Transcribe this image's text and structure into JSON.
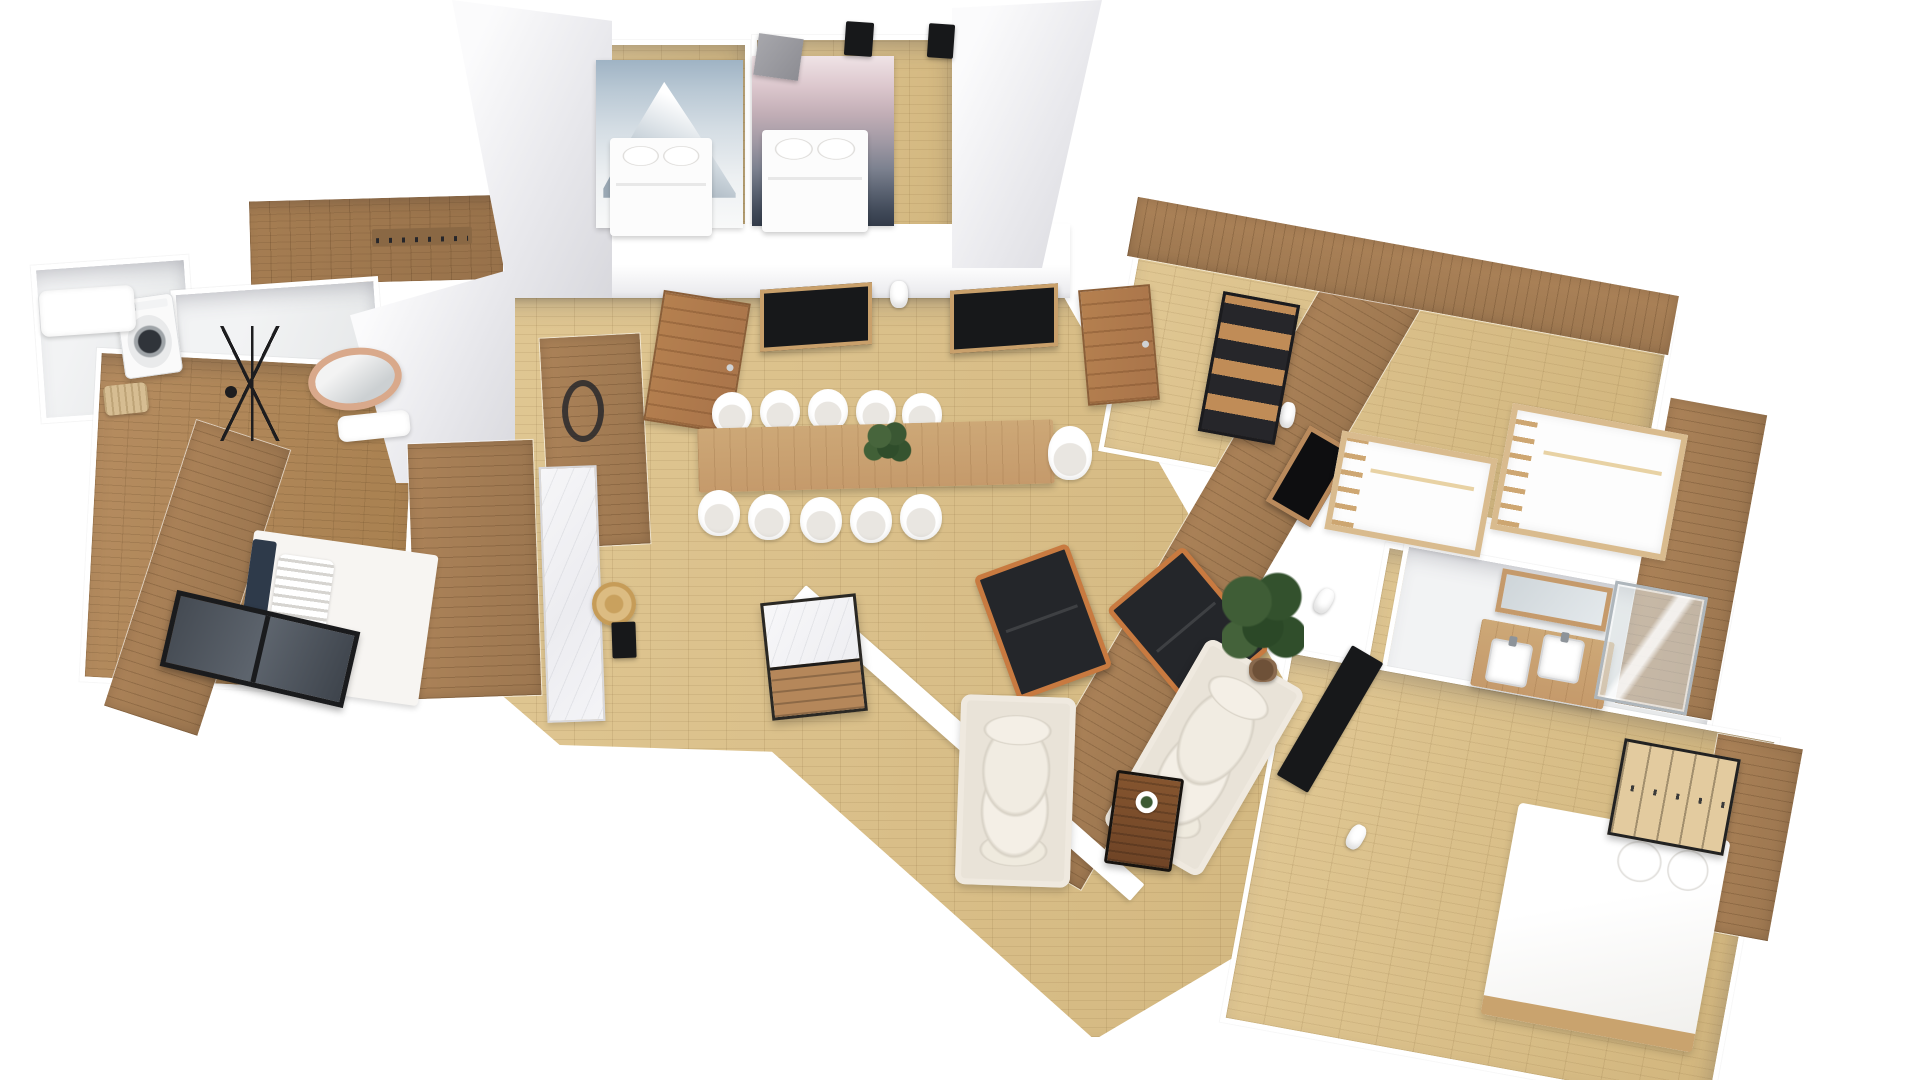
{
  "meta": {
    "width": 1920,
    "height": 1080,
    "view": "3d-floorplan-render",
    "background": "#ffffff"
  },
  "palette": {
    "oak": "#e0c793",
    "woodmid": "#ab8258",
    "wooddark": "#a57d52",
    "bedfloor": "#b58c60",
    "marble": "#f6f6f8",
    "orange": "#c87a40",
    "black": "#24262a",
    "sofa": "#e9e3d8",
    "navy": "#2e3a4a",
    "copper": "#d9a98b",
    "tv": "#17181a",
    "door": "#b5804f",
    "bunkwood": "#d9bb8e",
    "vanitywood": "#c59a6b",
    "plantgreen": "#3c5a33",
    "shade": "#e8e8ec"
  },
  "scene": {
    "items": [
      {
        "n": "floor-main-hall",
        "k": "floor-oak",
        "x": 455,
        "y": 292,
        "w": 935,
        "h": 750,
        "z": 1,
        "c": "polygon(0.5% 0.4%, 65% 0.4%, 100% 76.4%, 68.4% 99.7%, 33.9% 61.3%, 11.2% 60.4%, 0% 48.4%)"
      },
      {
        "n": "floor-bedroom-a",
        "k": "floor-oak",
        "x": 580,
        "y": 40,
        "w": 170,
        "h": 196,
        "z": 1
      },
      {
        "n": "floor-bedroom-b",
        "k": "floor-oak",
        "x": 752,
        "y": 35,
        "w": 205,
        "h": 201,
        "z": 1
      },
      {
        "n": "floor-entry-hall",
        "k": "floor-wood-dark",
        "x": 246,
        "y": 194,
        "w": 272,
        "h": 92,
        "r": -1.5,
        "z": 1
      },
      {
        "n": "floor-laundry",
        "k": "floor-light",
        "x": 36,
        "y": 260,
        "w": 158,
        "h": 158,
        "r": -4,
        "z": 1
      },
      {
        "n": "floor-bathroom-1",
        "k": "floor-light",
        "x": 176,
        "y": 283,
        "w": 208,
        "h": 168,
        "r": -4,
        "z": 1
      },
      {
        "n": "floor-bedroom-1",
        "k": "floor-wood-mid",
        "x": 88,
        "y": 356,
        "w": 324,
        "h": 334,
        "r": 3,
        "z": 1
      },
      {
        "n": "floor-bunkroom",
        "k": "floor-oak",
        "x": 1115,
        "y": 266,
        "w": 545,
        "h": 236,
        "r": 10.4,
        "z": 1
      },
      {
        "n": "floor-hall-right",
        "k": "floor-oak",
        "x": 1362,
        "y": 552,
        "w": 130,
        "h": 250,
        "r": 10.4,
        "z": 1
      },
      {
        "n": "floor-bathroom-2",
        "k": "floor-light",
        "x": 1388,
        "y": 570,
        "w": 335,
        "h": 158,
        "r": 10.4,
        "z": 1
      },
      {
        "n": "floor-bedroom-3",
        "k": "floor-oak",
        "x": 1250,
        "y": 690,
        "w": 500,
        "h": 380,
        "r": 10.4,
        "z": 1
      },
      {
        "n": "wall-hall-top",
        "k": "wall-band",
        "x": 503,
        "y": 224,
        "w": 567,
        "h": 74,
        "z": 2
      },
      {
        "n": "wall-slab-left-of-bedroom-a",
        "k": "white-shade",
        "x": 452,
        "y": 0,
        "w": 160,
        "h": 298,
        "z": 2,
        "c": "polygon(0% 0%, 100% 7%, 100% 100%, 36% 100%)"
      },
      {
        "n": "wall-slab-right-of-bedroom-b",
        "k": "white-shade",
        "x": 952,
        "y": 0,
        "w": 150,
        "h": 268,
        "z": 2,
        "c": "polygon(0% 3%, 100% 0%, 60% 100%, 0% 100%)"
      },
      {
        "n": "wall-face-kitchen-west",
        "k": "white-shade",
        "x": 350,
        "y": 268,
        "w": 165,
        "h": 215,
        "z": 2,
        "c": "polygon(0% 22%, 100% 0%, 100% 100%, 28% 100%)"
      },
      {
        "n": "media-wall",
        "k": "accent-wood-v",
        "x": 1167,
        "y": 217,
        "w": 96,
        "h": 696,
        "r": 30.3,
        "z": 2
      },
      {
        "n": "kitchen-wood-wall",
        "k": "accent-wood-v",
        "x": 412,
        "y": 442,
        "w": 125,
        "h": 255,
        "r": -2,
        "z": 2
      },
      {
        "n": "dining-wood-panel",
        "k": "accent-wood-v",
        "x": 545,
        "y": 336,
        "w": 100,
        "h": 210,
        "r": -3,
        "z": 2
      },
      {
        "n": "bunkroom-wood-wall-top",
        "k": "accent-wood",
        "x": 1128,
        "y": 246,
        "w": 550,
        "h": 60,
        "r": 10.4,
        "z": 2
      },
      {
        "n": "bunkroom-wood-wall-right",
        "k": "accent-wood-v",
        "x": 1642,
        "y": 404,
        "w": 98,
        "h": 310,
        "r": 10.4,
        "z": 2
      },
      {
        "n": "bedroom-3-wood-wall",
        "k": "accent-wood-v",
        "x": 1700,
        "y": 740,
        "w": 86,
        "h": 195,
        "r": 10.4,
        "z": 2
      },
      {
        "n": "bedroom-1-wood-wall",
        "k": "accent-wood-v",
        "x": 148,
        "y": 428,
        "w": 98,
        "h": 300,
        "r": 18,
        "z": 2
      },
      {
        "n": "wall-living-diagonal",
        "k": "wall-strip",
        "x": 742,
        "y": 732,
        "w": 452,
        "h": 22,
        "r": 41.5,
        "z": 2
      },
      {
        "n": "mural-mountain-photo",
        "k": "mural-a",
        "x": 596,
        "y": 60,
        "w": 147,
        "h": 168,
        "z": 3,
        "i": true
      },
      {
        "n": "mural-mountain-art",
        "k": "mural-b",
        "x": 752,
        "y": 56,
        "w": 142,
        "h": 170,
        "z": 3,
        "i": true
      },
      {
        "n": "desk-niche-a",
        "k": "niche",
        "x": 760,
        "y": 286,
        "w": 112,
        "h": 62,
        "sy": -4,
        "z": 3
      },
      {
        "n": "desk-niche-b",
        "k": "niche",
        "x": 950,
        "y": 287,
        "w": 108,
        "h": 63,
        "sy": -4,
        "z": 3
      },
      {
        "n": "door-bedroom-a",
        "k": "door",
        "x": 653,
        "y": 296,
        "w": 88,
        "h": 132,
        "r": 9,
        "z": 3,
        "i": true
      },
      {
        "n": "door-bedroom-b",
        "k": "door",
        "x": 1083,
        "y": 287,
        "w": 72,
        "h": 116,
        "r": -5,
        "z": 3,
        "i": true
      },
      {
        "n": "sconce-dining",
        "k": "sconce",
        "x": 890,
        "y": 281,
        "w": 18,
        "h": 27,
        "z": 3,
        "i": true
      },
      {
        "n": "wreath-decor",
        "k": "wreath",
        "x": 562,
        "y": 380,
        "w": 42,
        "h": 62,
        "z": 3,
        "i": true
      },
      {
        "n": "fireplace-recess",
        "k": "niche-fire",
        "x": 1284,
        "y": 432,
        "w": 52,
        "h": 88,
        "r": 30.3,
        "z": 3,
        "i": true
      },
      {
        "n": "tv-living",
        "k": "dark",
        "x": 1312,
        "y": 644,
        "w": 36,
        "h": 150,
        "r": 30.3,
        "z": 3,
        "i": true
      },
      {
        "n": "sconce-media-1",
        "k": "sconce",
        "x": 1280,
        "y": 402,
        "w": 15,
        "h": 26,
        "r": 10,
        "z": 3,
        "i": true
      },
      {
        "n": "sconce-media-2",
        "k": "sconce",
        "x": 1316,
        "y": 588,
        "w": 16,
        "h": 26,
        "r": 30,
        "z": 3,
        "i": true
      },
      {
        "n": "sconce-media-3",
        "k": "sconce",
        "x": 1348,
        "y": 824,
        "w": 16,
        "h": 26,
        "r": 30,
        "z": 3,
        "i": true
      },
      {
        "n": "tv-bedroom-a",
        "k": "dark",
        "x": 845,
        "y": 22,
        "w": 28,
        "h": 34,
        "r": 4,
        "z": 3,
        "i": true
      },
      {
        "n": "tv-bedroom-b",
        "k": "dark",
        "x": 928,
        "y": 24,
        "w": 26,
        "h": 34,
        "r": 4,
        "z": 3,
        "i": true
      },
      {
        "n": "coat-hook-rail",
        "k": "hooks",
        "x": 372,
        "y": 228,
        "w": 100,
        "h": 17,
        "r": -1.5,
        "z": 3,
        "i": true
      },
      {
        "n": "bed-bedroom-a",
        "k": "bed-white",
        "x": 610,
        "y": 138,
        "w": 102,
        "h": 98,
        "z": 4,
        "i": true
      },
      {
        "n": "bed-bedroom-b",
        "k": "bed-white",
        "x": 762,
        "y": 130,
        "w": 106,
        "h": 102,
        "z": 4,
        "i": true
      },
      {
        "n": "standing-mirror-panel",
        "k": "gray-panel",
        "x": 756,
        "y": 36,
        "w": 45,
        "h": 42,
        "r": 8,
        "z": 5,
        "i": true
      },
      {
        "n": "dining-table",
        "k": "wood-table",
        "x": 698,
        "y": 424,
        "w": 356,
        "h": 64,
        "r": -1.5,
        "z": 4,
        "i": true
      },
      {
        "n": "dining-centerpiece-plant",
        "k": "plant",
        "x": 862,
        "y": 420,
        "w": 50,
        "h": 46,
        "z": 5,
        "i": true
      },
      {
        "n": "dining-chair-1",
        "k": "chair",
        "x": 712,
        "y": 392,
        "w": 40,
        "h": 42,
        "z": 3,
        "i": true
      },
      {
        "n": "dining-chair-2",
        "k": "chair",
        "x": 760,
        "y": 390,
        "w": 40,
        "h": 42,
        "z": 3,
        "i": true
      },
      {
        "n": "dining-chair-3",
        "k": "chair",
        "x": 808,
        "y": 389,
        "w": 40,
        "h": 42,
        "z": 3,
        "i": true
      },
      {
        "n": "dining-chair-4",
        "k": "chair",
        "x": 856,
        "y": 390,
        "w": 40,
        "h": 42,
        "z": 3,
        "i": true
      },
      {
        "n": "dining-chair-5",
        "k": "chair",
        "x": 902,
        "y": 393,
        "w": 40,
        "h": 42,
        "z": 3,
        "i": true
      },
      {
        "n": "dining-chair-6",
        "k": "chair",
        "x": 698,
        "y": 490,
        "w": 42,
        "h": 46,
        "z": 5,
        "i": true
      },
      {
        "n": "dining-chair-7",
        "k": "chair",
        "x": 748,
        "y": 494,
        "w": 42,
        "h": 46,
        "z": 5,
        "i": true
      },
      {
        "n": "dining-chair-8",
        "k": "chair",
        "x": 800,
        "y": 497,
        "w": 42,
        "h": 46,
        "z": 5,
        "i": true
      },
      {
        "n": "dining-chair-9",
        "k": "chair",
        "x": 850,
        "y": 497,
        "w": 42,
        "h": 46,
        "z": 5,
        "i": true
      },
      {
        "n": "dining-chair-10",
        "k": "chair",
        "x": 900,
        "y": 494,
        "w": 42,
        "h": 46,
        "z": 5,
        "i": true
      },
      {
        "n": "dining-chair-end",
        "k": "chair",
        "x": 1048,
        "y": 426,
        "w": 44,
        "h": 54,
        "z": 5,
        "i": true
      },
      {
        "n": "kitchen-counter",
        "k": "marble",
        "x": 543,
        "y": 466,
        "w": 58,
        "h": 256,
        "r": -2,
        "z": 3,
        "i": true
      },
      {
        "n": "kitchen-straw-hat",
        "k": "hat",
        "x": 592,
        "y": 582,
        "w": 44,
        "h": 44,
        "z": 4,
        "i": true
      },
      {
        "n": "kitchen-black-board",
        "k": "dark",
        "x": 612,
        "y": 622,
        "w": 24,
        "h": 36,
        "r": -2,
        "z": 4,
        "i": true
      },
      {
        "n": "kitchen-island",
        "k": "island",
        "x": 766,
        "y": 598,
        "w": 96,
        "h": 118,
        "r": -6,
        "z": 4,
        "i": true
      },
      {
        "n": "armchair-1",
        "k": "armchair",
        "x": 993,
        "y": 556,
        "w": 100,
        "h": 132,
        "r": -20,
        "z": 4,
        "i": true
      },
      {
        "n": "armchair-2",
        "k": "armchair",
        "x": 1138,
        "y": 562,
        "w": 100,
        "h": 135,
        "r": -40,
        "z": 4,
        "i": true
      },
      {
        "n": "sofa-1",
        "k": "sofa",
        "x": 958,
        "y": 696,
        "w": 115,
        "h": 190,
        "r": 2,
        "z": 4,
        "i": true
      },
      {
        "n": "sofa-2",
        "k": "sofa",
        "x": 1148,
        "y": 650,
        "w": 112,
        "h": 215,
        "r": 30,
        "z": 4,
        "i": true
      },
      {
        "n": "coffee-table",
        "k": "coffee-table",
        "x": 1110,
        "y": 774,
        "w": 68,
        "h": 94,
        "r": 8,
        "z": 4,
        "i": true
      },
      {
        "n": "living-tall-plant",
        "k": "plant-big",
        "x": 1222,
        "y": 566,
        "w": 82,
        "h": 118,
        "z": 4,
        "i": true
      },
      {
        "n": "bookshelf",
        "k": "shelf-black",
        "x": 1210,
        "y": 297,
        "w": 78,
        "h": 142,
        "r": 10.4,
        "z": 3,
        "i": true
      },
      {
        "n": "bunk-bed-1",
        "k": "bunk",
        "x": 1332,
        "y": 444,
        "w": 158,
        "h": 100,
        "r": 10.4,
        "z": 3,
        "i": true
      },
      {
        "n": "bunk-bed-2",
        "k": "bunk",
        "x": 1500,
        "y": 418,
        "w": 178,
        "h": 128,
        "r": 10.4,
        "z": 3,
        "i": true
      },
      {
        "n": "bathroom-2-vanity",
        "k": "wood-table",
        "x": 1475,
        "y": 630,
        "w": 135,
        "h": 68,
        "r": 10.4,
        "z": 3,
        "i": true
      },
      {
        "n": "vanity-sink-1",
        "k": "sink",
        "x": 1488,
        "y": 641,
        "w": 42,
        "h": 44,
        "r": 10.4,
        "z": 4,
        "i": true
      },
      {
        "n": "vanity-sink-2",
        "k": "sink",
        "x": 1540,
        "y": 637,
        "w": 42,
        "h": 44,
        "r": 10.4,
        "z": 4,
        "i": true
      },
      {
        "n": "vanity-mirror",
        "k": "mirror-wood",
        "x": 1498,
        "y": 578,
        "w": 112,
        "h": 44,
        "r": 10.4,
        "z": 3,
        "i": true
      },
      {
        "n": "shower-enclosure",
        "k": "shower",
        "x": 1604,
        "y": 588,
        "w": 94,
        "h": 120,
        "r": 10.4,
        "z": 3,
        "i": true
      },
      {
        "n": "bed-bedroom-3",
        "k": "bed-big",
        "x": 1498,
        "y": 820,
        "w": 215,
        "h": 215,
        "r": 10.4,
        "z": 3,
        "i": true
      },
      {
        "n": "wardrobe-slatted",
        "k": "wardrobe-slat",
        "x": 1615,
        "y": 748,
        "w": 118,
        "h": 98,
        "r": 10.4,
        "z": 4,
        "i": true
      },
      {
        "n": "washing-machine",
        "k": "washer",
        "x": 120,
        "y": 296,
        "w": 58,
        "h": 80,
        "r": -8,
        "z": 3,
        "i": true
      },
      {
        "n": "laundry-counter",
        "k": "white-counter",
        "x": 40,
        "y": 288,
        "w": 95,
        "h": 46,
        "r": -4,
        "z": 3,
        "i": true
      },
      {
        "n": "laundry-basket",
        "k": "basket",
        "x": 104,
        "y": 384,
        "w": 44,
        "h": 30,
        "r": -6,
        "z": 3,
        "i": true
      },
      {
        "n": "round-copper-mirror",
        "k": "mirror-copper",
        "x": 308,
        "y": 348,
        "w": 94,
        "h": 62,
        "r": -8,
        "z": 3,
        "i": true
      },
      {
        "n": "towel-ladder-rack",
        "k": "rack-black",
        "x": 190,
        "y": 326,
        "w": 125,
        "h": 115,
        "z": 3,
        "i": true
      },
      {
        "n": "bathroom-1-sink",
        "k": "white-counter",
        "x": 338,
        "y": 413,
        "w": 72,
        "h": 26,
        "r": -6,
        "z": 3,
        "i": true
      },
      {
        "n": "bed-bedroom-1",
        "k": "bed-side",
        "x": 243,
        "y": 542,
        "w": 186,
        "h": 152,
        "r": 8,
        "z": 3,
        "i": true
      },
      {
        "n": "window-bedroom-1",
        "k": "window-dark",
        "x": 166,
        "y": 610,
        "w": 188,
        "h": 78,
        "r": 13,
        "z": 3,
        "i": true
      }
    ]
  }
}
